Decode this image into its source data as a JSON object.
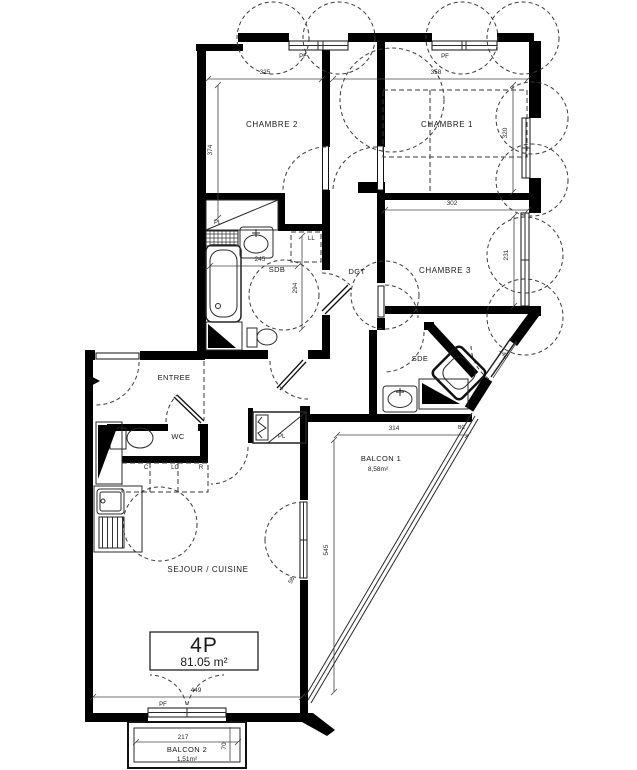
{
  "unit_info": {
    "type_label": "4P",
    "area_label": "81.05 m²"
  },
  "rooms": {
    "chambre2": {
      "label": "CHAMBRE 2"
    },
    "chambre1": {
      "label": "CHAMBRE 1"
    },
    "chambre3": {
      "label": "CHAMBRE 3"
    },
    "sdb": {
      "label": "SDB"
    },
    "dgt": {
      "label": "DGT"
    },
    "sde": {
      "label": "SDE"
    },
    "entree": {
      "label": "ENTREE"
    },
    "wc": {
      "label": "WC"
    },
    "sejour": {
      "label": "SEJOUR / CUISINE"
    },
    "balcon1": {
      "label": "BALCON 1",
      "area": "8,58m²"
    },
    "balcon2": {
      "label": "BALCON 2",
      "area": "1,51m²"
    }
  },
  "annotations": {
    "pl_chambre2": "PL",
    "pl_entree": "PL",
    "ll": "LL",
    "c": "C",
    "lc": "LC",
    "r": "R",
    "pf_top_left": "PF",
    "pf_top_right": "PF",
    "pf_bottom": "PF",
    "bc": "BC",
    "d58": "58"
  },
  "dimensions": {
    "chambre2_width": "325",
    "chambre2_height": "374",
    "chambre1_width": "358",
    "chambre1_height": "320",
    "chambre3_width": "302",
    "chambre3_height": "231",
    "sdb_width": "245",
    "sdb_height": "294",
    "sde_window": "140",
    "balcon1_width": "314",
    "balcon1_height": "545",
    "sejour_bay": "449",
    "balcon2_width": "217",
    "balcon2_depth": "70"
  },
  "colors": {
    "wall": "#000000",
    "thin": "#2a2a2a",
    "dash": "#3a3a3a",
    "bg": "#ffffff"
  }
}
